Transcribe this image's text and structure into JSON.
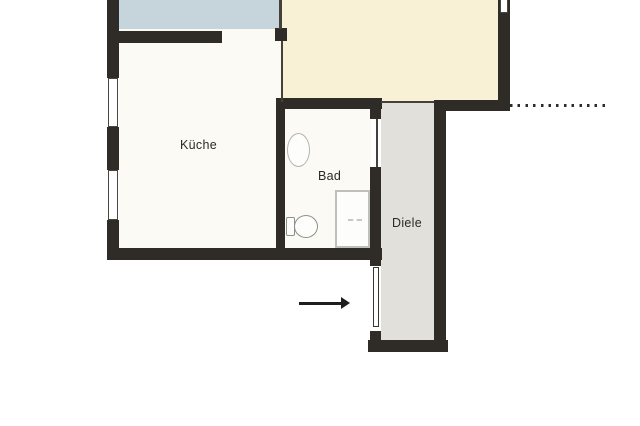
{
  "rooms": {
    "kueche": {
      "label": "Küche",
      "fill": "#fbfaf4"
    },
    "bad": {
      "label": "Bad",
      "fill": "#fbfaf4"
    },
    "diele": {
      "label": "Diele",
      "fill": "#e1e0db"
    },
    "room_top_left_partial": {
      "label": "",
      "fill": "#c6d4db"
    },
    "room_top_right_partial": {
      "label": "",
      "fill": "#f8f1d6"
    }
  },
  "colors": {
    "wall": "#2f2b26",
    "background": "#ffffff",
    "thin_partition_line": "#45403a",
    "hall_floor": "#e1e0db",
    "fixture_outline": "#8f8f89"
  },
  "symbols": {
    "fixtures": [
      "sink",
      "toilet",
      "shower-tray"
    ],
    "windows_visible": 3,
    "interior_doors_visible": 2,
    "entrance_arrow_direction": "right",
    "boundary_dotted_line_dot_count": 13
  }
}
